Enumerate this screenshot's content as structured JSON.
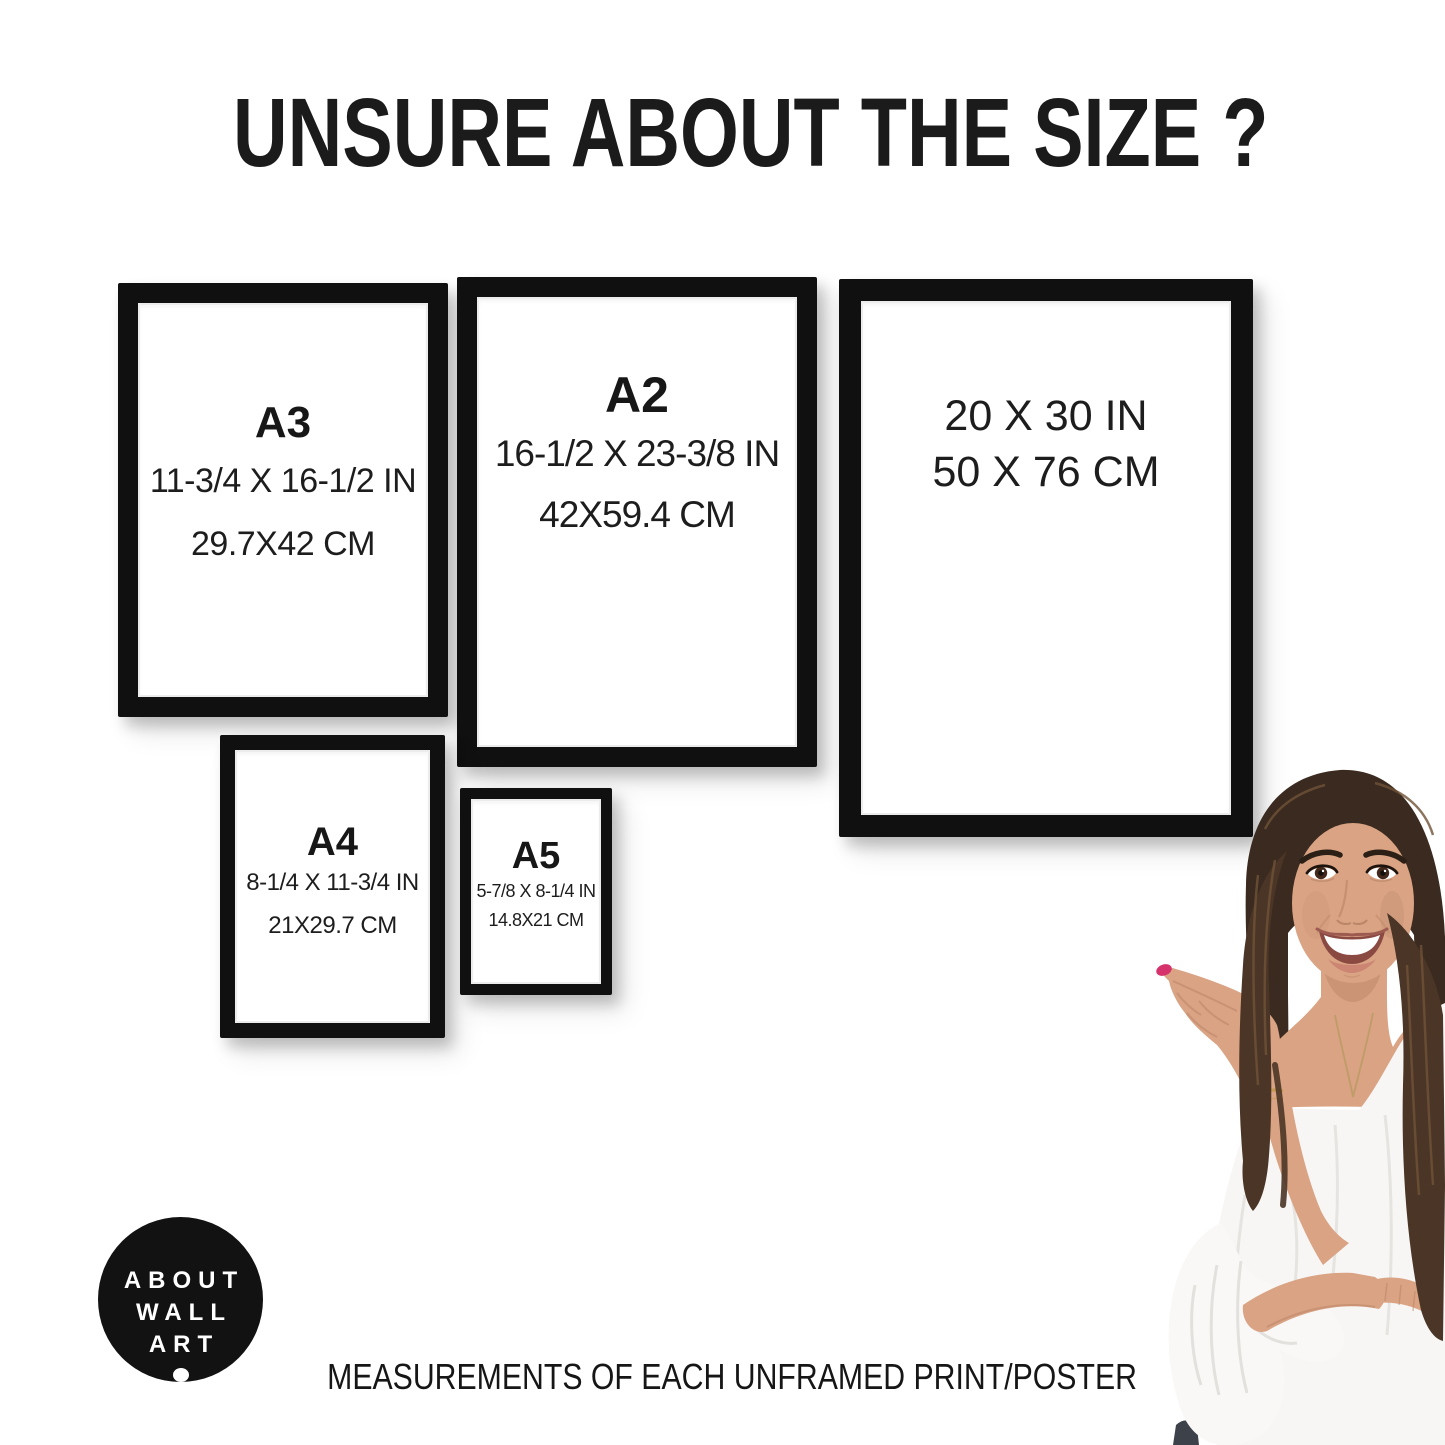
{
  "title": "UNSURE ABOUT THE SIZE ?",
  "frames": {
    "a3": {
      "label": "A3",
      "inches": "11-3/4 X 16-1/2 IN",
      "cm": "29.7X42 CM"
    },
    "a2": {
      "label": "A2",
      "inches": "16-1/2 X 23-3/8 IN",
      "cm": "42X59.4 CM"
    },
    "p2030": {
      "inches": "20 X 30 IN",
      "cm": "50 X 76 CM"
    },
    "a4": {
      "label": "A4",
      "inches": "8-1/4 X 11-3/4 IN",
      "cm": "21X29.7 CM"
    },
    "a5": {
      "label": "A5",
      "inches": "5-7/8 X 8-1/4 IN",
      "cm": "14.8X21 CM"
    }
  },
  "logo": {
    "line1": "ABOUT",
    "line2": "WALL",
    "line3": "ART"
  },
  "footer": {
    "caption": "MEASUREMENTS OF EACH UNFRAMED PRINT/POSTER"
  },
  "colors": {
    "background": "#ffffff",
    "frame_black": "#101010",
    "text": "#1b1b1b",
    "logo_background": "#121212",
    "logo_text": "#ffffff",
    "hair_brown": "#3a2a1f",
    "skin_tone": "#d9a384",
    "blouse_white": "#f7f6f4",
    "nail_polish": "#d6336c",
    "jeans_dark": "#3c414a",
    "bracelet_gold": "#c59a4f"
  }
}
